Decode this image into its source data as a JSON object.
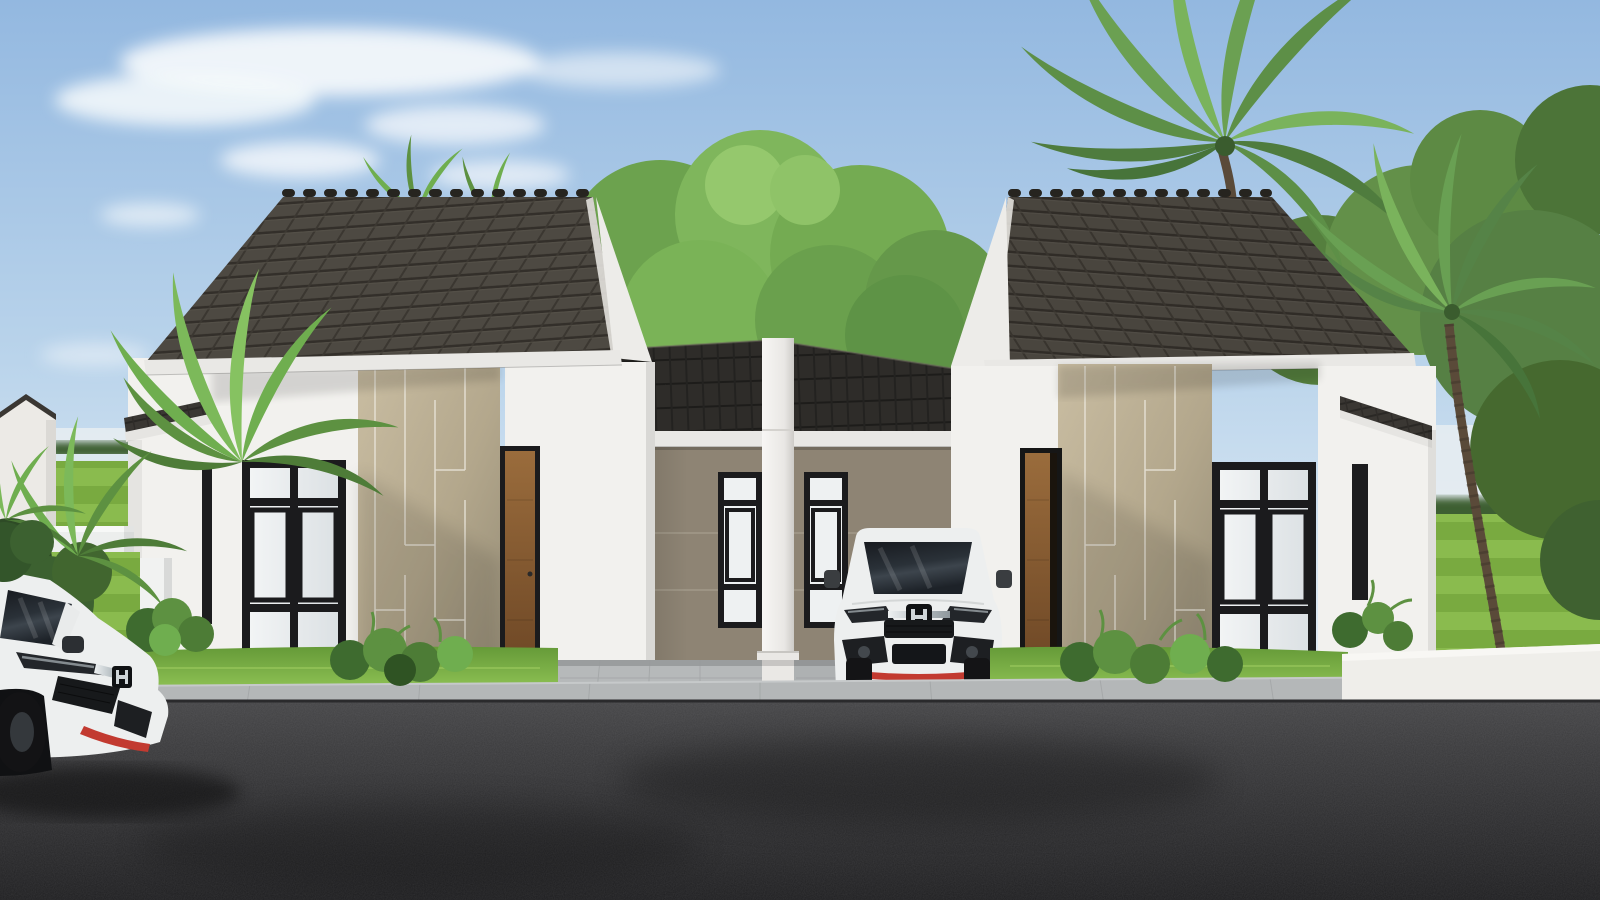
{
  "scene": {
    "description": "3D architectural rendering of two symmetrical modern minimalist single-storey houses with steep dark tiled gable roofs, beige accent cladding panels, black framed windows and wooden doors. A shared central carport holds a white Honda hatchback; a second white hatchback sits in the left foreground. Tropical palms and leafy trees surround the houses, with green striped lawns, low white boundary walls, a concrete driveway apron and a dark asphalt road in front under a blue sky with scattered clouds.",
    "setting": "daytime exterior, clear blue sky, scattered white clouds",
    "objects": [
      "left house",
      "right house",
      "central carport",
      "white divider pillar",
      "white hatchback parked in carport",
      "white hatchback foreground left",
      "palm trees",
      "background trees",
      "striped lawn",
      "shrubs",
      "white boundary walls",
      "planter box",
      "concrete driveway",
      "asphalt road"
    ]
  },
  "colors": {
    "sky_top": "#93b8e0",
    "sky_horizon": "#e8eff6",
    "cloud": "#f7fafc",
    "roof_tile": "#4d4942",
    "roof_tile_dark": "#2e2c29",
    "fascia": "#e9e8e5",
    "wall_white": "#f2f1ee",
    "accent_panel": "#b3a78c",
    "carport_wall": "#8e8474",
    "pillar": "#f1f0ed",
    "window_frame": "#1b1b1d",
    "glass": "#eef1f2",
    "door_wood": "#7d5229",
    "foliage": "#5d9141",
    "palm_green": "#6ba052",
    "trunk_brown": "#5a4a39",
    "grass": "#7ab344",
    "lawn_stripe_light": "#8abb4e",
    "lawn_stripe_dark": "#79aa40",
    "concrete": "#b5b8b9",
    "road": "#39393b",
    "car_white": "#edefef",
    "car_red_accent": "#c23a30",
    "car_glass": "#22262c",
    "fence_white": "#efeeea"
  }
}
